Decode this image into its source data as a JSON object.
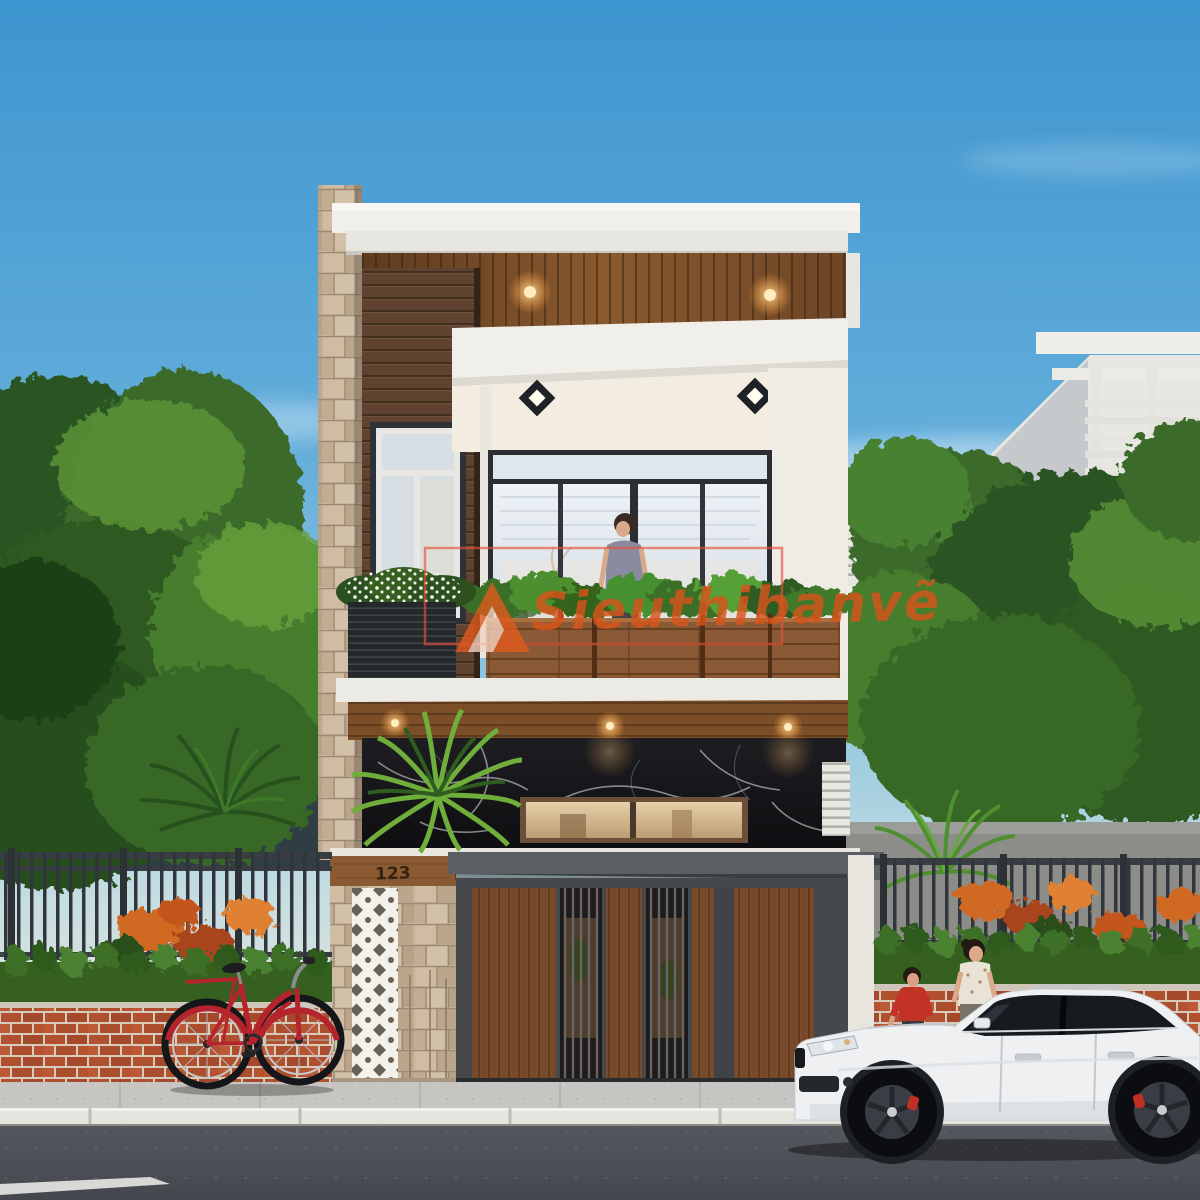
{
  "meta": {
    "type": "3d architectural exterior rendering",
    "setting": "two-story modern townhouse street view at dusk"
  },
  "watermark": {
    "text": "Sieuthibanvẽ",
    "logo": "orange-triangle-logo",
    "frame_color": "#e8503a",
    "text_color": "#d8541c"
  },
  "house": {
    "number": "123",
    "style": "modern flat-roof townhouse",
    "materials": [
      "white stucco",
      "dark timber siding",
      "rough stone pillar",
      "black marble",
      "timber gate",
      "white breeze blocks"
    ],
    "lighting": [
      "warm recessed ceiling spots",
      "diamond wall sconces"
    ]
  },
  "street": {
    "vehicle": "white SUV",
    "bicycle": "red city bicycle",
    "pedestrians": [
      "woman",
      "child in red shirt"
    ],
    "road_marking": "white painted line"
  },
  "palette": {
    "sky_top": "#3d95cf",
    "sky_mid": "#8ec6e0",
    "sky_horizon": "#eceadb",
    "wall_white": "#f1efe9",
    "wood_dark": "#5f4230",
    "wood_warm": "#8a5a36",
    "soffit_wood": "#7c4e28",
    "stone": "#c6b29a",
    "marble": "#17171a",
    "brick": "#b0502e",
    "hedge": "#35601f",
    "foliage": "#3c6e2c",
    "metal": "#383d43",
    "road": "#55575e",
    "sidewalk": "#c6c5c1",
    "car_body": "#eef0f2",
    "bicycle_red": "#b5242c",
    "flower_orange": "#d06a24",
    "glow": "#ffd89a"
  }
}
